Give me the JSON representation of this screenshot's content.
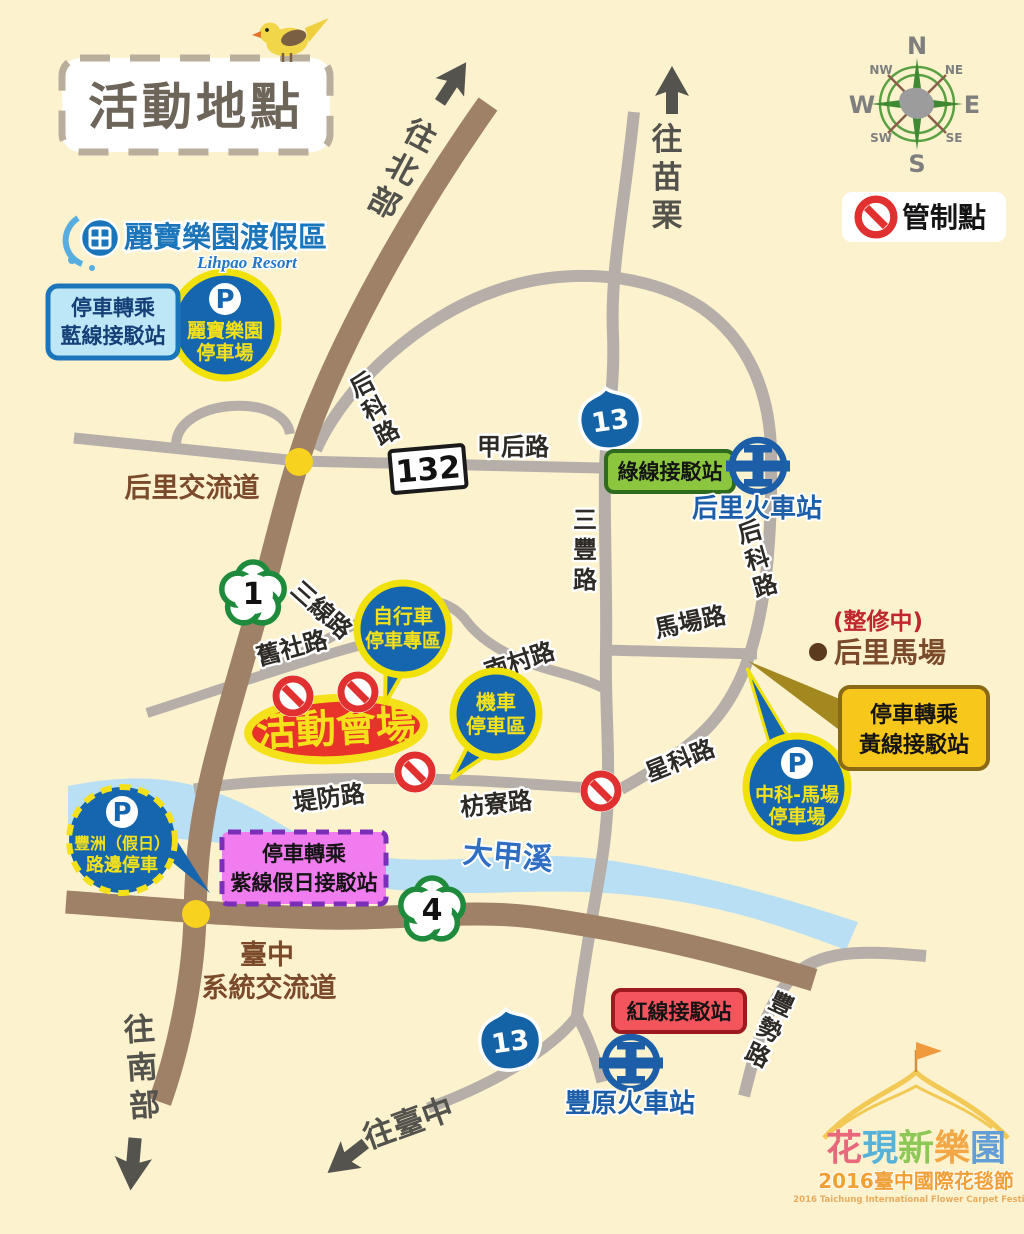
{
  "title": "活動地點",
  "legend": {
    "control_point": "管制點"
  },
  "compass": {
    "n": "N",
    "e": "E",
    "s": "S",
    "w": "W",
    "nw": "NW",
    "ne": "NE",
    "sw": "SW",
    "se": "SE"
  },
  "lihpao": {
    "name_zh": "麗寶樂園渡假區",
    "name_en": "Lihpao Resort"
  },
  "boxes": {
    "blue_shuttle": [
      "停車轉乘",
      "藍線接駁站"
    ],
    "green_shuttle": "綠線接駁站",
    "yellow_shuttle": [
      "停車轉乘",
      "黃線接駁站"
    ],
    "purple_shuttle": [
      "停車轉乘",
      "紫線假日接駁站"
    ],
    "red_shuttle": "紅線接駁站"
  },
  "parking": {
    "p_icon": "P",
    "lihpao": [
      "麗寶樂園",
      "停車場"
    ],
    "bicycle": [
      "自行車",
      "停車專區"
    ],
    "motorcycle": [
      "機車",
      "停車區"
    ],
    "zhongke": [
      "中科-馬場",
      "停車場"
    ],
    "fengzhou": [
      "豐洲（假日）",
      "路邊停車"
    ]
  },
  "venue": "活動會場",
  "rail": {
    "houli": "后里火車站",
    "fengyuan": "豐原火車站"
  },
  "interchange": {
    "houli": "后里交流道",
    "taichung": [
      "臺中",
      "系統交流道"
    ]
  },
  "ranch": {
    "status": "(整修中)",
    "name": "后里馬場"
  },
  "river": "大甲溪",
  "roads": {
    "houke_nw": "后科路",
    "houke_e": "后科路",
    "jiahou": "甲后路",
    "sanfeng": "三豐路",
    "machang": "馬場路",
    "xingke": "星科路",
    "nancun": "南村路",
    "sanxian": "三線路",
    "jiushe": "舊社路",
    "difang": "堤防路",
    "fangliao": "枋寮路",
    "fengshi": "豐勢路"
  },
  "directions": {
    "north": "往北部",
    "miaoli": "往苗栗",
    "south": "往南部",
    "taichung": "往臺中"
  },
  "markers": {
    "freeway1": "1",
    "freeway4": "4",
    "provincial13_n": "13",
    "provincial13_s": "13",
    "county132": "132"
  },
  "footer": {
    "title": "花現新樂園",
    "title_colors": [
      "#E8506E",
      "#3BA7DC",
      "#7AC143",
      "#F29A2E",
      "#4A90D9"
    ],
    "subtitle": "2016臺中國際花毯節",
    "subtitle_en": "2016 Taichung International Flower Carpet Festival"
  },
  "colors": {
    "background": "#FCF2CE",
    "road": "#B6AFA9",
    "highway": "#9F8168",
    "river": "#B9DFF4",
    "venue_red": "#E8332A",
    "callout_blue": "#1566AE",
    "callout_yellow": "#F0E10B",
    "green_box": "#8CC63E",
    "yellow_box": "#F8C71B",
    "purple_box": "#F07CF0",
    "red_box": "#F4555C",
    "blue_box": "#BDE6F7",
    "rail_blue": "#1C5FA8",
    "no_entry_red": "#E03030",
    "interchange_dot": "#F7D21E"
  }
}
